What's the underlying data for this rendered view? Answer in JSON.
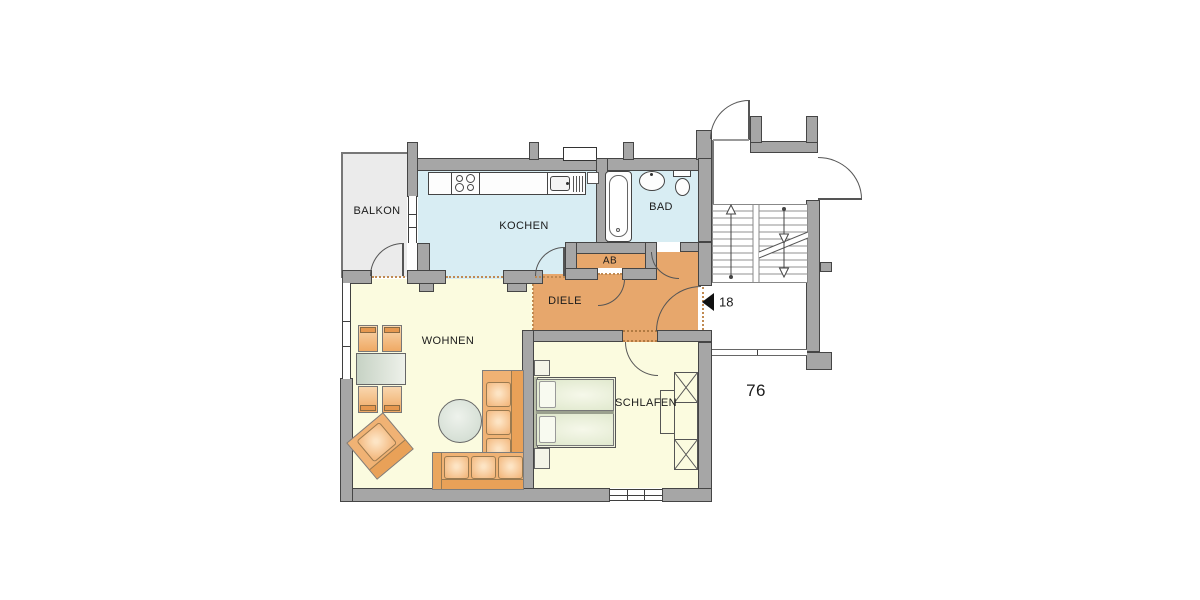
{
  "rooms": {
    "balkon": "BALKON",
    "kochen": "KOCHEN",
    "bad": "BAD",
    "ab": "AB",
    "diele": "DIELE",
    "wohnen": "WOHNEN",
    "schlafen": "SCHLAFEN"
  },
  "annotations": {
    "apartment_number": "18",
    "floor_area_number": "76"
  },
  "fixtures": [
    "stove-icon",
    "sink-icon",
    "bathtub-icon",
    "washbasin-icon",
    "toilet-icon",
    "dining-table",
    "chair",
    "round-table",
    "sofa",
    "armchair",
    "double-bed",
    "nightstand",
    "wardrobe",
    "staircase",
    "entrance-arrow-icon"
  ],
  "colors": {
    "wall": "#a6a6a6",
    "wall_outline": "#454545",
    "wet_room_floor": "#d8edf3",
    "hall_floor": "#e7a76c",
    "living_floor": "#fbfbdf",
    "balcony_floor": "#ebebeb",
    "furniture_accent": "#f3b87e"
  }
}
